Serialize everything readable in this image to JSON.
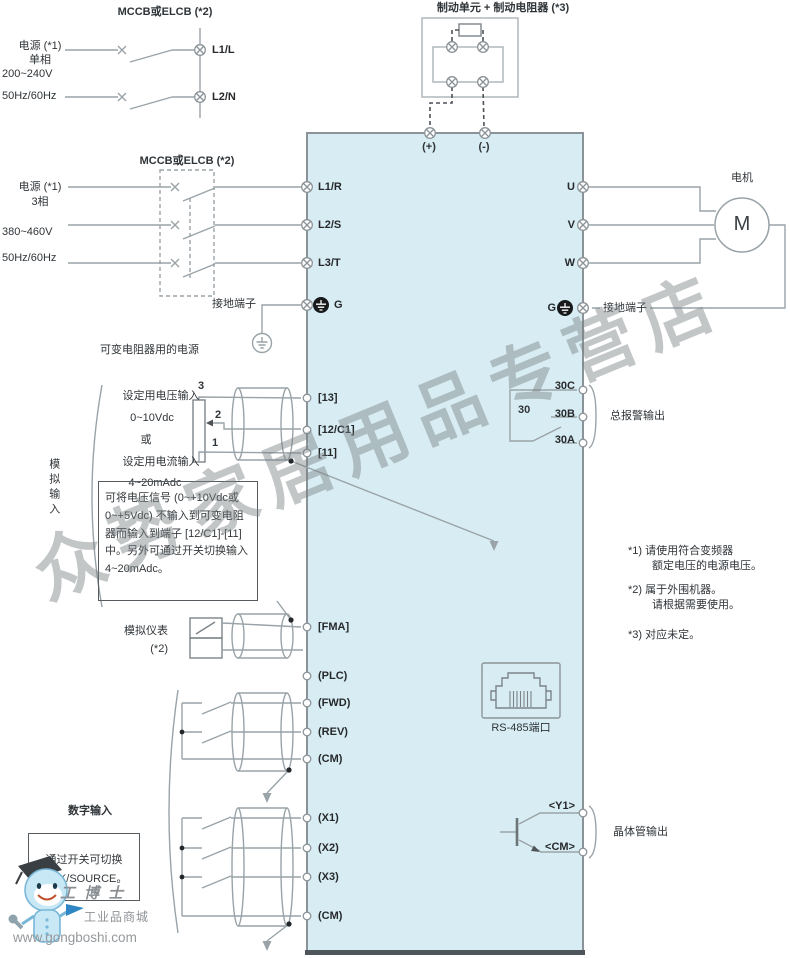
{
  "watermark": "众势家居用品专营店",
  "brake": {
    "title": "制动单元 + 制动电阻器 (*3)",
    "plus": "(+)",
    "minus": "(-)"
  },
  "single_phase": {
    "breaker": "MCCB或ELCB (*2)",
    "source": "电源 (*1)",
    "phase": "单相",
    "voltage": "200~240V",
    "freq": "50Hz/60Hz",
    "t1": "L1/L",
    "t2": "L2/N"
  },
  "three_phase": {
    "breaker": "MCCB或ELCB (*2)",
    "source": "电源 (*1)",
    "phase": "3相",
    "voltage": "380~460V",
    "freq": "50Hz/60Hz",
    "t1": "L1/R",
    "t2": "L2/S",
    "t3": "L3/T",
    "g": "G",
    "ground_terminal": "接地端子",
    "pot_power": "可变电阻器用的电源"
  },
  "motor_out": {
    "u": "U",
    "v": "V",
    "w": "W",
    "motor": "M",
    "motor_label": "电机",
    "g": "G",
    "ground_terminal": "接地端子"
  },
  "alarm": {
    "relay": "30",
    "c": "30C",
    "b": "30B",
    "a": "30A",
    "label": "总报警输出"
  },
  "analog": {
    "group": "模拟输入",
    "volt": "设定用电压输入",
    "volt_range": "0~10Vdc",
    "or": "或",
    "curr": "设定用电流输入",
    "curr_range": "4~20mAdc",
    "pot3": "3",
    "pot2": "2",
    "pot1": "1",
    "t13": "[13]",
    "t12": "[12/C1]",
    "t11": "[11]",
    "note": "可将电压信号 (0~+10Vdc或0~+5Vdc) 不输入到可变电阻器而输入到端子 [12/C1]-[11]中。另外可通过开关切换输入4~20mAdc。",
    "meter": "模拟仪表",
    "meter_ref": "(*2)",
    "fma": "[FMA]"
  },
  "digital": {
    "group": "数字输入",
    "plc": "(PLC)",
    "fwd": "(FWD)",
    "rev": "(REV)",
    "cm1": "(CM)",
    "x1": "(X1)",
    "x2": "(X2)",
    "x3": "(X3)",
    "cm2": "(CM)",
    "sink_note_1": "通过开关可切换",
    "sink_note_2": "SINK/SOURCE。"
  },
  "comm": {
    "rs485": "RS-485端口"
  },
  "transistor": {
    "y1": "<Y1>",
    "cm": "<CM>",
    "label": "晶体管输出"
  },
  "notes": {
    "n1a": "*1) 请使用符合变频器",
    "n1b": "额定电压的电源电压。",
    "n2a": "*2) 属于外围机器。",
    "n2b": "请根据需要使用。",
    "n3": "*3) 对应未定。"
  },
  "logo": {
    "brand": "工博士",
    "mall": "工业品商城",
    "url": "www.gongboshi.com"
  },
  "colors": {
    "block_fill": "#d8edf3",
    "line": "#99a3a8",
    "text": "#2f3438"
  }
}
